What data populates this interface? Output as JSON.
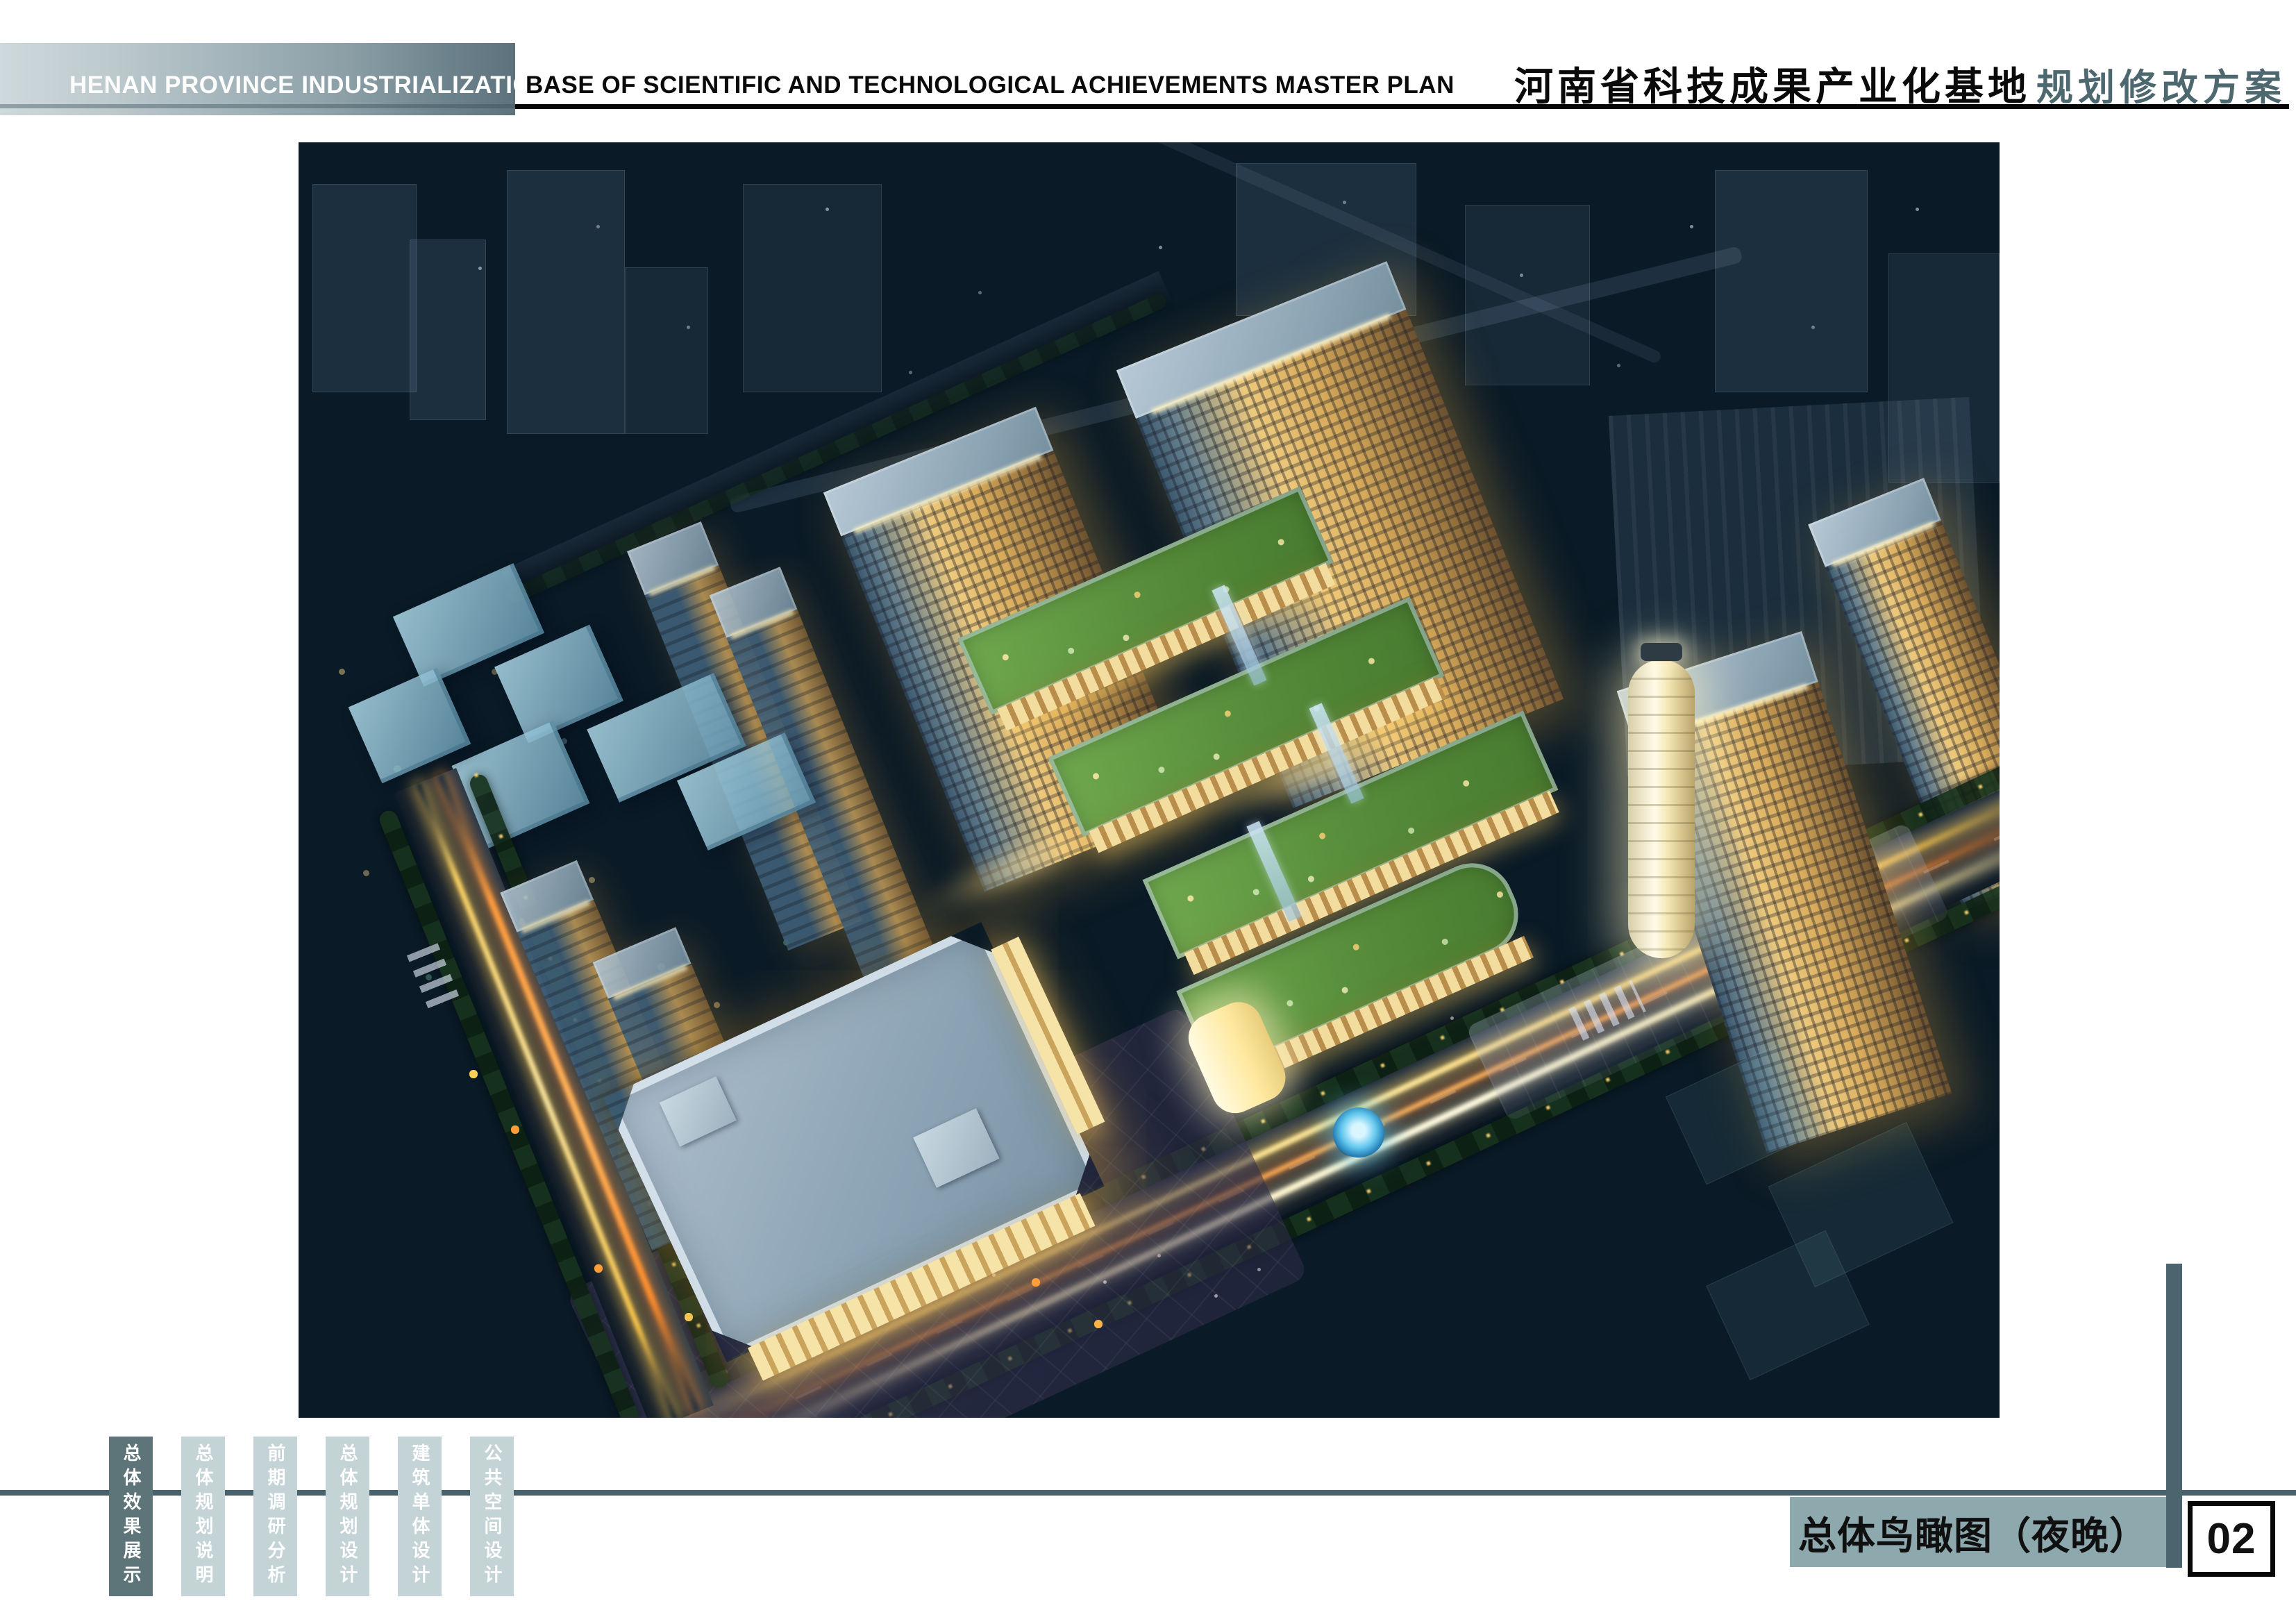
{
  "header": {
    "title_en_highlight": "HENAN PROVINCE INDUSTRIALIZATION",
    "title_en_rest": "BASE OF SCIENTIFIC AND TECHNOLOGICAL ACHIEVEMENTS MASTER PLAN",
    "title_cn": "河南省科技成果产业化基地",
    "subtitle_cn": "规划修改方案"
  },
  "footer": {
    "tabs": [
      {
        "label": "总体效果展示",
        "active": true
      },
      {
        "label": "总体规划说明",
        "active": false
      },
      {
        "label": "前期调研分析",
        "active": false
      },
      {
        "label": "总体规划设计",
        "active": false
      },
      {
        "label": "建筑单体设计",
        "active": false
      },
      {
        "label": "公共空间设计",
        "active": false
      }
    ],
    "caption": "总体鸟瞰图（夜晚）",
    "page_number": "02"
  },
  "colors": {
    "header_gradient_start": "#ced9dc",
    "header_gradient_end": "#5d727c",
    "subtitle_teal": "#4d686e",
    "rule_black": "#050505",
    "footer_rule": "#48626d",
    "tab_active": "#5d7478",
    "tab_inactive": "#c3d3d6",
    "caption_bar": "#8da9ae",
    "side_bar": "#4c646e",
    "sky_top": "#4d88c6",
    "ground_dark": "#06101a",
    "lit_facade": "#edc97d",
    "green_roof": "#558b39",
    "light_trail": "#ffd564"
  }
}
